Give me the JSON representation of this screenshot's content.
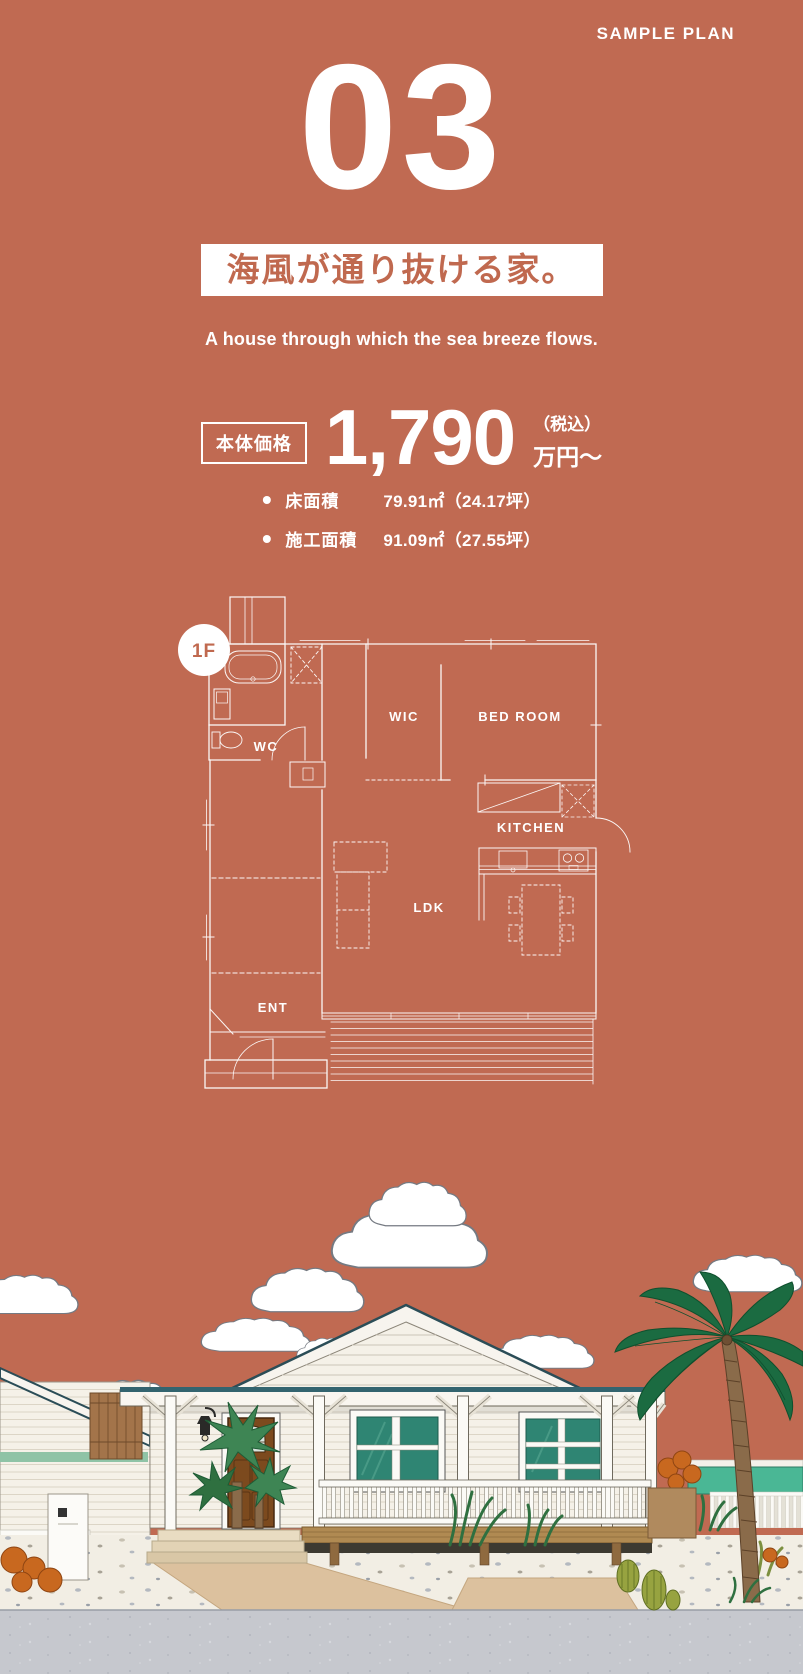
{
  "header": {
    "eyebrow": "SAMPLE PLAN",
    "plan_number": "03",
    "title": "海風が通り抜ける家。",
    "subtitle": "A house through which the sea breeze flows."
  },
  "price": {
    "label": "本体価格",
    "amount": "1,790",
    "tax_note": "（税込）",
    "unit": "万円〜"
  },
  "specs": [
    {
      "label": "床面積",
      "value": "79.91㎡（24.17坪）"
    },
    {
      "label": "施工面積",
      "value": "91.09㎡（27.55坪）"
    }
  ],
  "floor_plan": {
    "badge": "1F",
    "labels": {
      "wic": "WIC",
      "bedroom": "BED ROOM",
      "wc": "WC",
      "kitchen": "KITCHEN",
      "ldk": "LDK",
      "ent": "ENT"
    }
  },
  "colors": {
    "background": "#c06a52",
    "title_text": "#c0694f",
    "plan_lines": "#ffffff",
    "roof_trim": "#2b4d57",
    "window_glass": "#2f8573",
    "neighbor_wall_teal": "#4ab795",
    "door_brown": "#7c4a1e",
    "palm_green": "#1b6b41",
    "path_tan": "#dcc19e",
    "road_gray": "#c6c8ce"
  }
}
